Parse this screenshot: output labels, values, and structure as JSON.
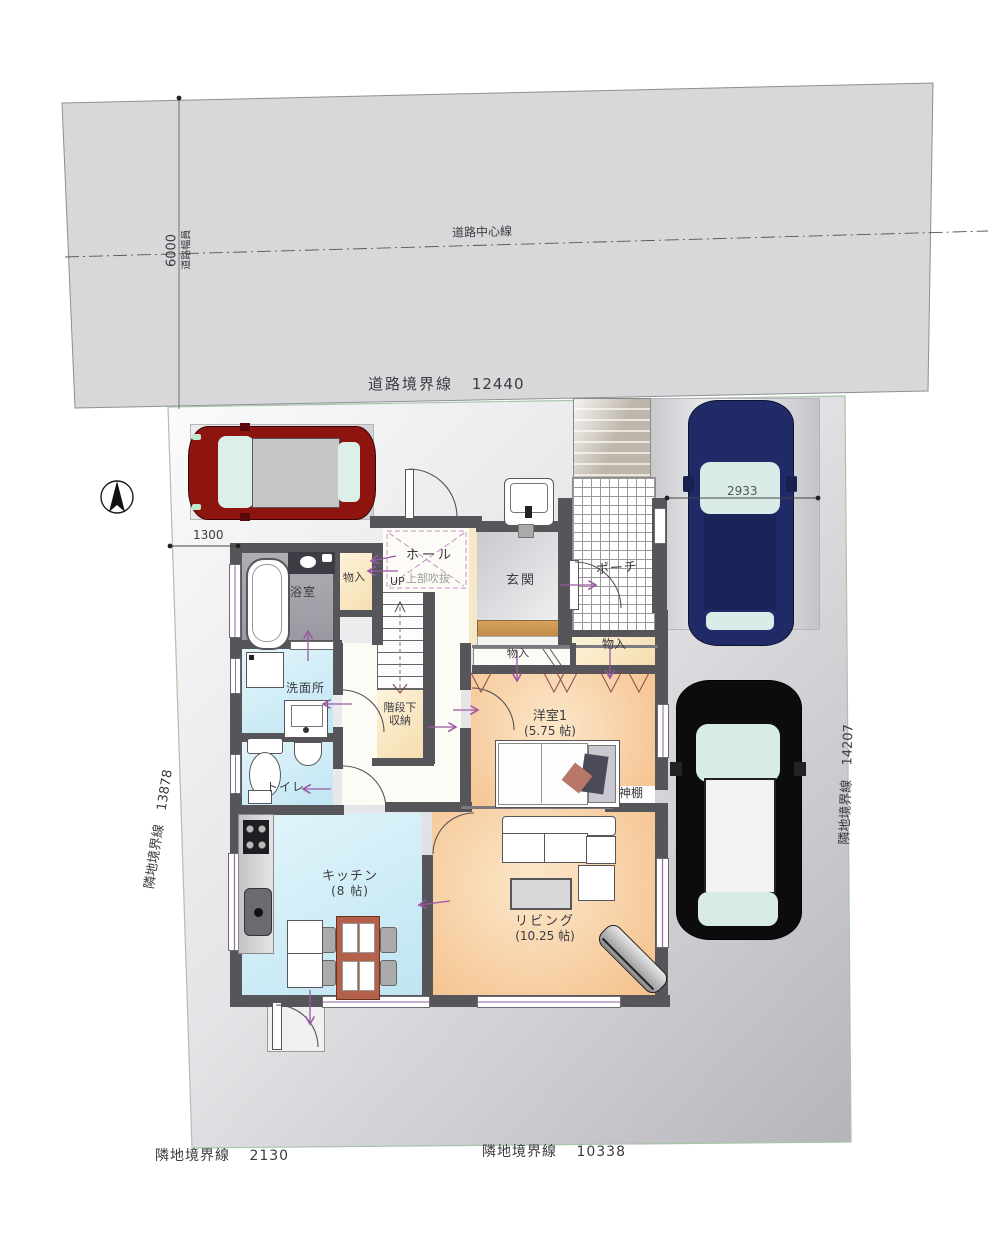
{
  "site": {
    "road_center_line": "道路中心線",
    "road_width_value": "6000",
    "road_width_label": "道路幅員",
    "road_boundary_label": "道路境界線",
    "road_boundary_value": "12440",
    "left_boundary_label": "隣地境界線",
    "left_boundary_value": "13878",
    "right_boundary_label": "隣地境界線",
    "right_boundary_value": "14207",
    "bottom_left_boundary_label": "隣地境界線",
    "bottom_left_boundary_value": "2130",
    "bottom_right_boundary_label": "隣地境界線",
    "bottom_right_boundary_value": "10338",
    "parking_dim_left": "1300",
    "parking_dim_right": "2933"
  },
  "rooms": {
    "hall": "ホール",
    "void_above": "上部吹抜",
    "stairs_up": "UP",
    "entrance": "玄関",
    "porch": "ポーチ",
    "bath": "浴室",
    "storage": "物入",
    "washroom": "洗面所",
    "under_stair_line1": "階段下",
    "under_stair_line2": "収納",
    "toilet": "トイレ",
    "western_room": "洋室1",
    "western_room_size": "(5.75 帖)",
    "kamidana": "神棚",
    "kitchen": "キッチン",
    "kitchen_size": "(8 帖)",
    "living": "リビング",
    "living_size": "(10.25 帖)"
  },
  "colors": {
    "wall": "#55555a",
    "road_surface": "#d8d8da",
    "wood_floor": "#f5c08b",
    "wet_area_floor": "#cdeaf6",
    "closet_floor": "#f5ddae",
    "entrance_step": "#c89455",
    "flow_arrow": "#9c57a5",
    "void_dashed_line": "#c590c5",
    "red_car": "#8e1410",
    "blue_car": "#202a66",
    "black_car": "#0c0c0e"
  }
}
